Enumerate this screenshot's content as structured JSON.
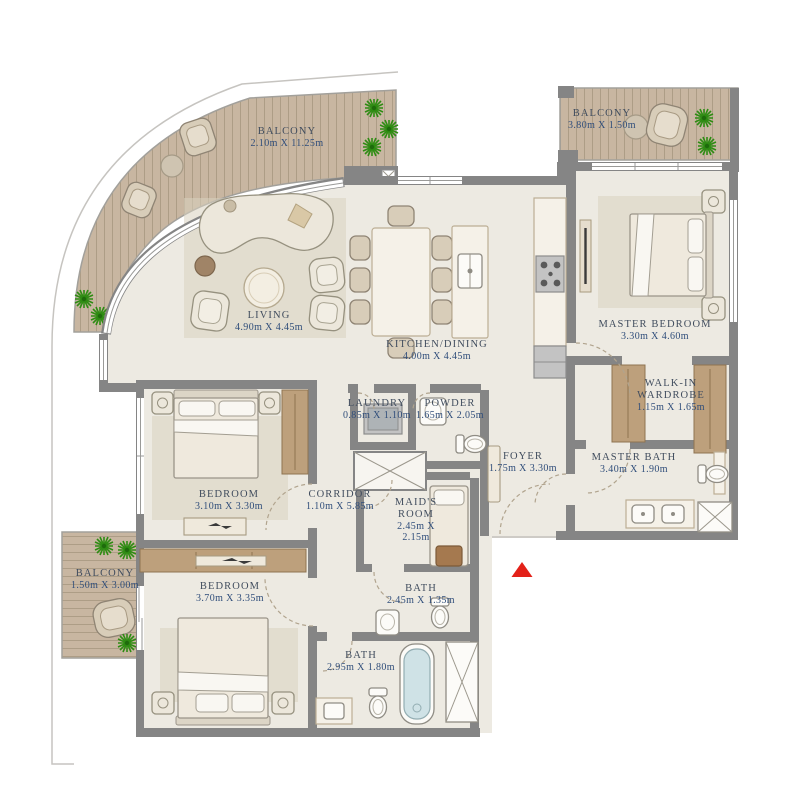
{
  "plan": {
    "title": "Apartment floor plan",
    "colors": {
      "wall": "#858585",
      "floor": "#edeae2",
      "deck": "#c8b6a1",
      "deck_line": "#97886f",
      "accent": "#e32119",
      "label_name": "#414d5e",
      "label_dims": "#2f4d7a",
      "plant": "#2e8c13",
      "wood": "#bda07c",
      "tub": "#cfe2e6"
    },
    "entrance_marker": "triangle-up"
  },
  "rooms": {
    "balcony_top": {
      "name": "BALCONY",
      "dims": "2.10m X 11.25m"
    },
    "balcony_right": {
      "name": "BALCONY",
      "dims": "3.80m X 1.50m"
    },
    "balcony_left": {
      "name": "BALCONY",
      "dims": "1.50m X 3.00m"
    },
    "living": {
      "name": "LIVING",
      "dims": "4.90m X 4.45m"
    },
    "kitchen": {
      "name": "KITCHEN/DINING",
      "dims": "4.00m X 4.45m"
    },
    "master_bedroom": {
      "name": "MASTER BEDROOM",
      "dims": "3.30m X 4.60m"
    },
    "walkin": {
      "name": "WALK-IN WARDROBE",
      "dims": "1.15m X 1.65m"
    },
    "master_bath": {
      "name": "MASTER BATH",
      "dims": "3.40m X 1.90m"
    },
    "laundry": {
      "name": "LAUNDRY",
      "dims": "0.85m X 1.10m"
    },
    "powder": {
      "name": "POWDER",
      "dims": "1.65m X 2.05m"
    },
    "foyer": {
      "name": "FOYER",
      "dims": "1.75m X 3.30m"
    },
    "bedroom2": {
      "name": "BEDROOM",
      "dims": "3.10m X 3.30m"
    },
    "corridor": {
      "name": "CORRIDOR",
      "dims": "1.10m X 5.85m"
    },
    "maids_room": {
      "name": "MAID'S ROOM",
      "dims": "2.45m X 2.15m"
    },
    "bath_maids": {
      "name": "BATH",
      "dims": "2.45m X 1.35m"
    },
    "bedroom3": {
      "name": "BEDROOM",
      "dims": "3.70m X 3.35m"
    },
    "bath2": {
      "name": "BATH",
      "dims": "2.95m X 1.80m"
    }
  }
}
